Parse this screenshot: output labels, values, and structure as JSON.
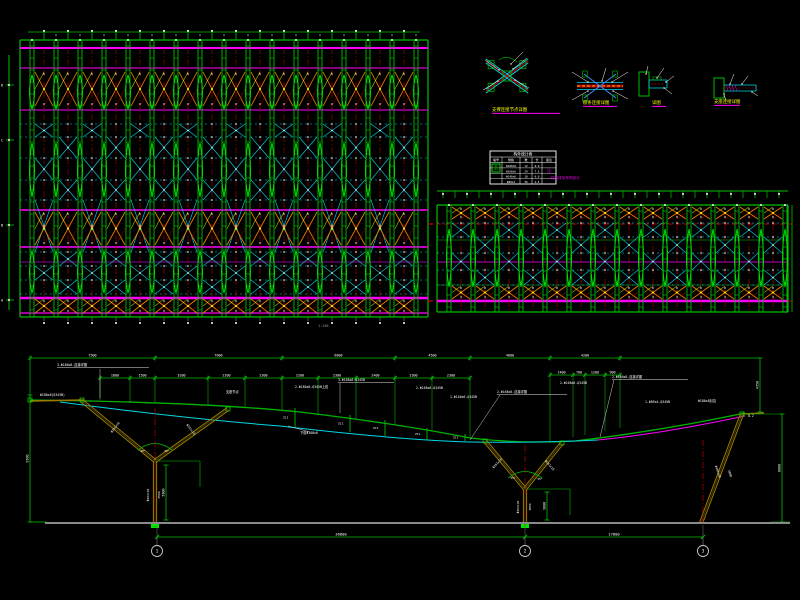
{
  "app": {
    "title": "CAD structural drawing",
    "bg": "#000000"
  },
  "colors": {
    "green": "#00c000",
    "bright_green": "#00e800",
    "magenta": "#ff00ff",
    "purple": "#b000d0",
    "cyan": "#00d8e8",
    "red": "#b40000",
    "orange": "#ff8000",
    "yellow": "#ffff00",
    "white": "#ffffff",
    "olive": "#9a7d00",
    "gray": "#8a8a8a",
    "dim_text": "#ffffff"
  },
  "plan_left": {
    "x0": 20,
    "y0": 40,
    "x1": 428,
    "y1": 317,
    "col_start": 32,
    "dx": 24,
    "cols": 17,
    "magenta_rows": [
      [
        48,
        2
      ],
      [
        68,
        1
      ],
      [
        110,
        1
      ],
      [
        210,
        1.5
      ],
      [
        247,
        1.5
      ],
      [
        298,
        2.5
      ],
      [
        313,
        1.2
      ]
    ],
    "purple_rows": [
      [
        262,
        0.8
      ]
    ],
    "orange_bands": [
      [
        72,
        106
      ],
      [
        212,
        245
      ],
      [
        299,
        313
      ]
    ],
    "cyan_rows": [
      124,
      137,
      158,
      180,
      200,
      252,
      266,
      280,
      294
    ],
    "lens": [
      [
        92,
        34
      ],
      [
        170,
        54
      ],
      [
        272,
        42
      ]
    ],
    "ruler_labels": [
      "D",
      "C",
      "B",
      "A"
    ],
    "ruler_ys": [
      85,
      140,
      225,
      300
    ],
    "scale_note": "1:150"
  },
  "plan_right": {
    "x0": 437,
    "y0": 205,
    "x1": 788,
    "y1": 312,
    "col_start": 449,
    "dx": 24,
    "cols": 15,
    "strip_y": 191,
    "magenta_rows": [
      [
        301,
        2.5
      ],
      [
        262,
        0.8
      ]
    ],
    "orange_bands": [
      [
        207,
        219
      ],
      [
        286,
        299
      ]
    ],
    "cyan_rows": [
      223,
      237,
      253,
      270,
      285
    ],
    "green_rows": [
      240,
      285
    ],
    "red_dash_rows": [
      224,
      301
    ],
    "lens": [
      [
        258,
        58
      ]
    ]
  },
  "details": [
    {
      "title": "支撑连接节点详图",
      "tx": 492,
      "ty": 111,
      "ul": 68
    },
    {
      "title": "檩条连接详图",
      "tx": 583,
      "ty": 104,
      "ul": 34
    },
    {
      "title": "详图",
      "tx": 652,
      "ty": 104,
      "ul": 14
    },
    {
      "title": "支座连接详图",
      "tx": 714,
      "ty": 103,
      "ul": 26
    }
  ],
  "table": {
    "x": 490,
    "y": 151,
    "w": 66,
    "h": 33,
    "title": "构件统计表",
    "headers": [
      "编号",
      "规格",
      "数",
      "长",
      "备注"
    ],
    "rows": [
      [
        "Z1",
        "Φ180x8",
        "12",
        "9.0",
        ""
      ],
      [
        "",
        "Φ168x6",
        "24",
        "7.5",
        ""
      ],
      [
        "",
        "Φ140x6",
        "18",
        "6.0",
        ""
      ],
      [
        "",
        "Φ89x4",
        "36",
        "4.5",
        ""
      ]
    ],
    "symbol": "Z1"
  },
  "note": {
    "lines": [
      "注:",
      "拉索详见专项设计"
    ]
  },
  "elevation": {
    "chainA": {
      "y": 358,
      "ticks": [
        30,
        155,
        282,
        395,
        470,
        550,
        620
      ],
      "labels": [
        "7500",
        "7600",
        "6800",
        "4500",
        "4800",
        "4200"
      ]
    },
    "chainB": {
      "y": 378,
      "ticks": [
        100,
        130,
        155,
        208,
        245,
        282,
        318,
        356,
        395,
        432,
        470
      ],
      "labels": [
        "1800",
        "1500",
        "3200",
        "2200",
        "2300",
        "2200",
        "2300",
        "2400",
        "2300",
        "2300"
      ]
    },
    "chainB2": {
      "y": 375,
      "ticks": [
        550,
        573,
        585,
        605,
        620
      ],
      "labels": [
        "1400",
        "700",
        "1200",
        "900"
      ]
    },
    "drops": [
      [
        100,
        400
      ],
      [
        130,
        402
      ],
      [
        155,
        403
      ],
      [
        208,
        406
      ],
      [
        245,
        408
      ],
      [
        282,
        410
      ],
      [
        318,
        414
      ],
      [
        356,
        419
      ],
      [
        395,
        425
      ],
      [
        432,
        431
      ],
      [
        470,
        438
      ],
      [
        550,
        441
      ],
      [
        573,
        437
      ],
      [
        585,
        435
      ],
      [
        605,
        431
      ],
      [
        620,
        428
      ]
    ],
    "vdims": [
      {
        "x": 30,
        "y1": 395,
        "y2": 522,
        "label": "9500"
      },
      {
        "x": 760,
        "y1": 358,
        "y2": 412,
        "label": "4350"
      },
      {
        "x": 782,
        "y1": 414,
        "y2": 522,
        "label": "8000"
      },
      {
        "x": 166,
        "y1": 465,
        "y2": 520,
        "label": "5800"
      },
      {
        "x": 547,
        "y1": 492,
        "y2": 520,
        "label": "3600"
      }
    ],
    "struts": [
      [
        295,
        408,
        427
      ],
      [
        350,
        415,
        432
      ],
      [
        385,
        420,
        436
      ],
      [
        427,
        428,
        440
      ],
      [
        465,
        434,
        441
      ]
    ],
    "strut_label": "ZC1",
    "columns": [
      {
        "node": [
          155,
          461
        ],
        "left": [
          82,
          401
        ],
        "right": [
          228,
          409
        ],
        "base": [
          155,
          527
        ],
        "cl": [
          155,
          408,
          527
        ]
      },
      {
        "node": [
          525,
          489
        ],
        "left": [
          485,
          441
        ],
        "right": [
          562,
          443
        ],
        "base": [
          525,
          527
        ],
        "cl": [
          525,
          445,
          527
        ]
      },
      {
        "top": [
          742,
          414
        ],
        "base": [
          701,
          523
        ],
        "cl": [
          703,
          440,
          523
        ]
      }
    ],
    "annotations": [
      {
        "x": 57,
        "y": 366,
        "t": "3-Φ180x8-连接详图",
        "u": 92
      },
      {
        "x": 40,
        "y": 396,
        "t": "Φ180x8(Q345B)"
      },
      {
        "x": 226,
        "y": 393,
        "t": "支座节点"
      },
      {
        "x": 295,
        "y": 388,
        "t": "2-Φ180x8-Q345B上弦"
      },
      {
        "x": 338,
        "y": 381,
        "t": "3-Φ168x8-Q345B",
        "u": 56
      },
      {
        "x": 416,
        "y": 389,
        "t": "2-Φ168x6-Q345B"
      },
      {
        "x": 450,
        "y": 398,
        "t": "1-Φ140x6-Q345B"
      },
      {
        "x": 497,
        "y": 393,
        "t": "2-Φ168x6-连接详图",
        "u": 70
      },
      {
        "x": 560,
        "y": 384,
        "t": "2-Φ168x6-Q345B"
      },
      {
        "x": 612,
        "y": 378,
        "t": "2-Φ180x8-连接详图",
        "u": 76
      },
      {
        "x": 645,
        "y": 403,
        "t": "1-Φ89x4-Q345B"
      },
      {
        "x": 300,
        "y": 434,
        "t": "下弦Φ168x6"
      },
      {
        "x": 698,
        "y": 402,
        "t": "Φ180x8封边"
      },
      {
        "x": 748,
        "y": 417,
        "t": "8.2"
      }
    ],
    "leaders": [
      [
        100,
        369,
        100,
        398
      ],
      [
        310,
        432,
        288,
        426
      ],
      [
        614,
        380,
        600,
        437
      ],
      [
        500,
        395,
        470,
        440
      ],
      [
        340,
        383,
        340,
        413
      ]
    ],
    "rot_labels": [
      {
        "x": 116,
        "y": 428,
        "t": "Φ351x16",
        "r": -52
      },
      {
        "x": 190,
        "y": 430,
        "t": "Φ351x16",
        "r": 52
      },
      {
        "x": 149,
        "y": 495,
        "t": "Φ402x20",
        "r": -90
      },
      {
        "x": 160,
        "y": 495,
        "t": "4500",
        "r": -90
      },
      {
        "x": 498,
        "y": 464,
        "t": "Φ351x16",
        "r": -48
      },
      {
        "x": 549,
        "y": 466,
        "t": "Φ351x16",
        "r": 48
      },
      {
        "x": 519,
        "y": 507,
        "t": "Φ402x20",
        "r": -90
      },
      {
        "x": 531,
        "y": 507,
        "t": "3800",
        "r": -90
      },
      {
        "x": 717,
        "y": 472,
        "t": "Φ402x20",
        "r": 70
      },
      {
        "x": 729,
        "y": 474,
        "t": "5800",
        "r": 70
      }
    ],
    "angle_labels": [
      {
        "x": 143,
        "y": 452,
        "t": "60°"
      },
      {
        "x": 167,
        "y": 452,
        "t": "60°"
      },
      {
        "x": 513,
        "y": 479,
        "t": "55°"
      },
      {
        "x": 540,
        "y": 480,
        "t": "55°"
      }
    ],
    "ground": {
      "x1": 45,
      "x2": 790,
      "y": 523
    },
    "bottom_dim": {
      "y": 537,
      "ticks": [
        157,
        525,
        703
      ],
      "labels": [
        "36800",
        "17800"
      ]
    },
    "bubbles": [
      {
        "x": 157,
        "label": "1"
      },
      {
        "x": 525,
        "label": "2"
      },
      {
        "x": 703,
        "label": "3"
      }
    ],
    "bubble_y": 551
  }
}
